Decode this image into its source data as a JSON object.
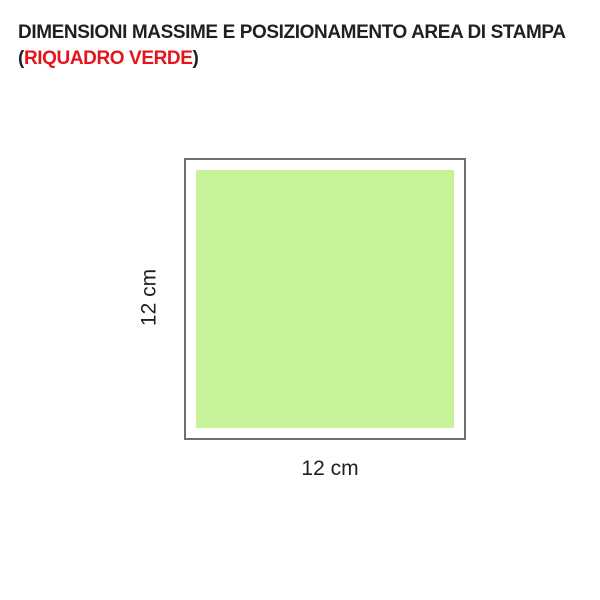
{
  "title": {
    "line1": "DIMENSIONI MASSIME E POSIZIONAMENTO AREA DI STAMPA",
    "line2_open": "(",
    "line2_highlight": "RIQUADRO VERDE",
    "line2_close": ")"
  },
  "diagram": {
    "width_label": "12 cm",
    "height_label": "12 cm"
  },
  "colors": {
    "title_text": "#221f1f",
    "highlight_red": "#e8121a",
    "frame_border": "#6f6f6f",
    "print_area_green": "#c7f297",
    "label_text": "#231f20",
    "page_bg": "#ffffff"
  }
}
